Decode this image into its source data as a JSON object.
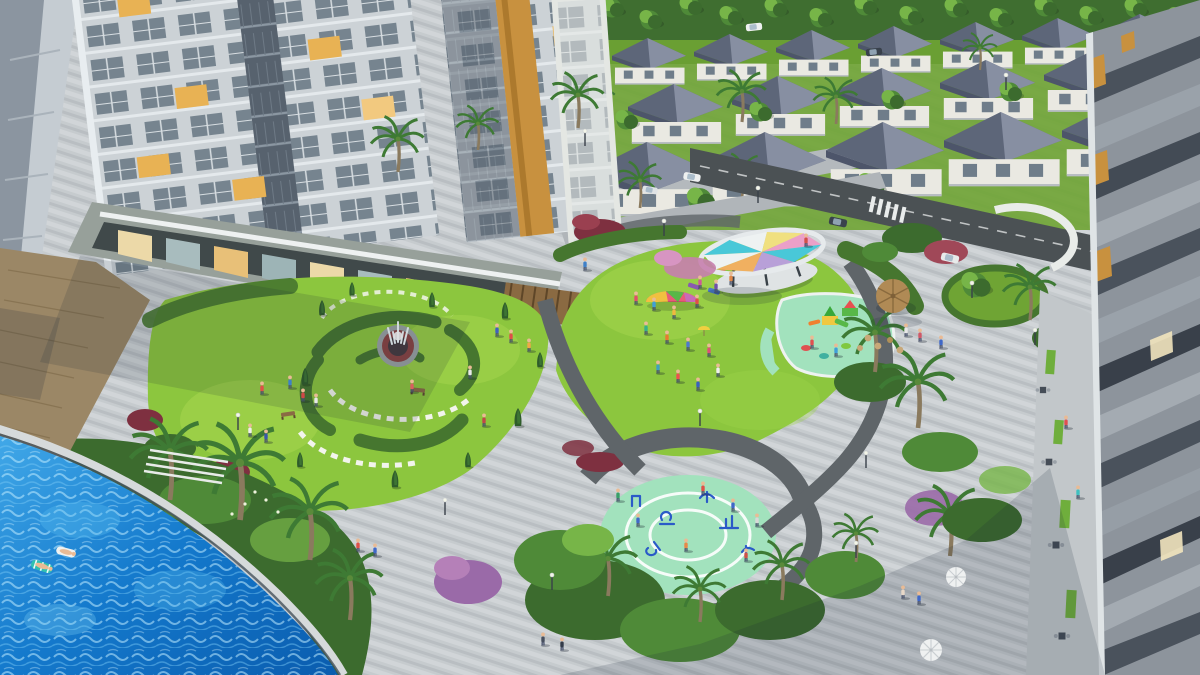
{
  "scene": {
    "title": "Aerial 3D architectural rendering of a residential complex with landscaped central park",
    "type": "photorealistic-render",
    "time_of_day": "late afternoon with long shadows",
    "regions": [
      {
        "name": "highrise-towers",
        "description": "Light gray apartment towers top-left with glass windows, some lit warm, gold accent stripe"
      },
      {
        "name": "retail-podium",
        "description": "Shop fronts with awnings and wooden pergola at tower base"
      },
      {
        "name": "villa-neighborhood",
        "description": "Rows of white villas with slate hipped roofs along tree-lined streets, top right"
      },
      {
        "name": "central-park",
        "description": "Curved lawns, hedges, fountain garden, event canopy with colored panels, playground, fitness circle"
      },
      {
        "name": "swimming-pool",
        "description": "Bright blue pool bottom-left with two floating loungers and curved glass edge"
      },
      {
        "name": "foreground-tower",
        "description": "Residential tower edge on right with orange accents and cafe walkway below"
      },
      {
        "name": "plaza",
        "description": "Striped stone paving with walkers, street lamps, umbrellas and thatch gazebo"
      }
    ],
    "counts": {
      "people_visible_approx": 45,
      "villas_visible_approx": 18,
      "palm_trees_approx": 14,
      "pool_floats": 2,
      "umbrellas": 2,
      "cars": 6
    },
    "features": [
      "fountain with red brick ring",
      "rainbow play parachute on lawn",
      "mint rubber fitness circle with white rings and blue equipment",
      "stepping-stone arcs in garden",
      "crosswalk stripes",
      "cypress trees",
      "red and pink flowering shrubs"
    ]
  },
  "palette": {
    "base_paving": "#c6cbce",
    "paving_stripe": "#ffffff",
    "asphalt": "#4b5154",
    "path_dark": "#5f6569",
    "lawn_bright": "#8cc63e",
    "lawn_mid": "#6fa434",
    "foliage_dark": "#3c6b2e",
    "foliage_mid": "#4f8a38",
    "foliage_light": "#77b548",
    "hedge_dark": "#46762f",
    "mint_surface": "#a2e2bd",
    "pool_blue": "#1583d6",
    "pool_light": "#58bdf0",
    "deck_wood": "#9b8766",
    "roof_slate": "#5d6679",
    "roof_light": "#8e96a9",
    "villa_wall": "#eae9e2",
    "tower_facade": "#ccd2d6",
    "window_cool": "#76848f",
    "window_lit": "#e8b254",
    "gold_accent": "#c8913f",
    "thatch": "#b08a55",
    "red_bush": "#7e3040",
    "pink_flower": "#c77fae",
    "shadow": "#1a2638"
  }
}
